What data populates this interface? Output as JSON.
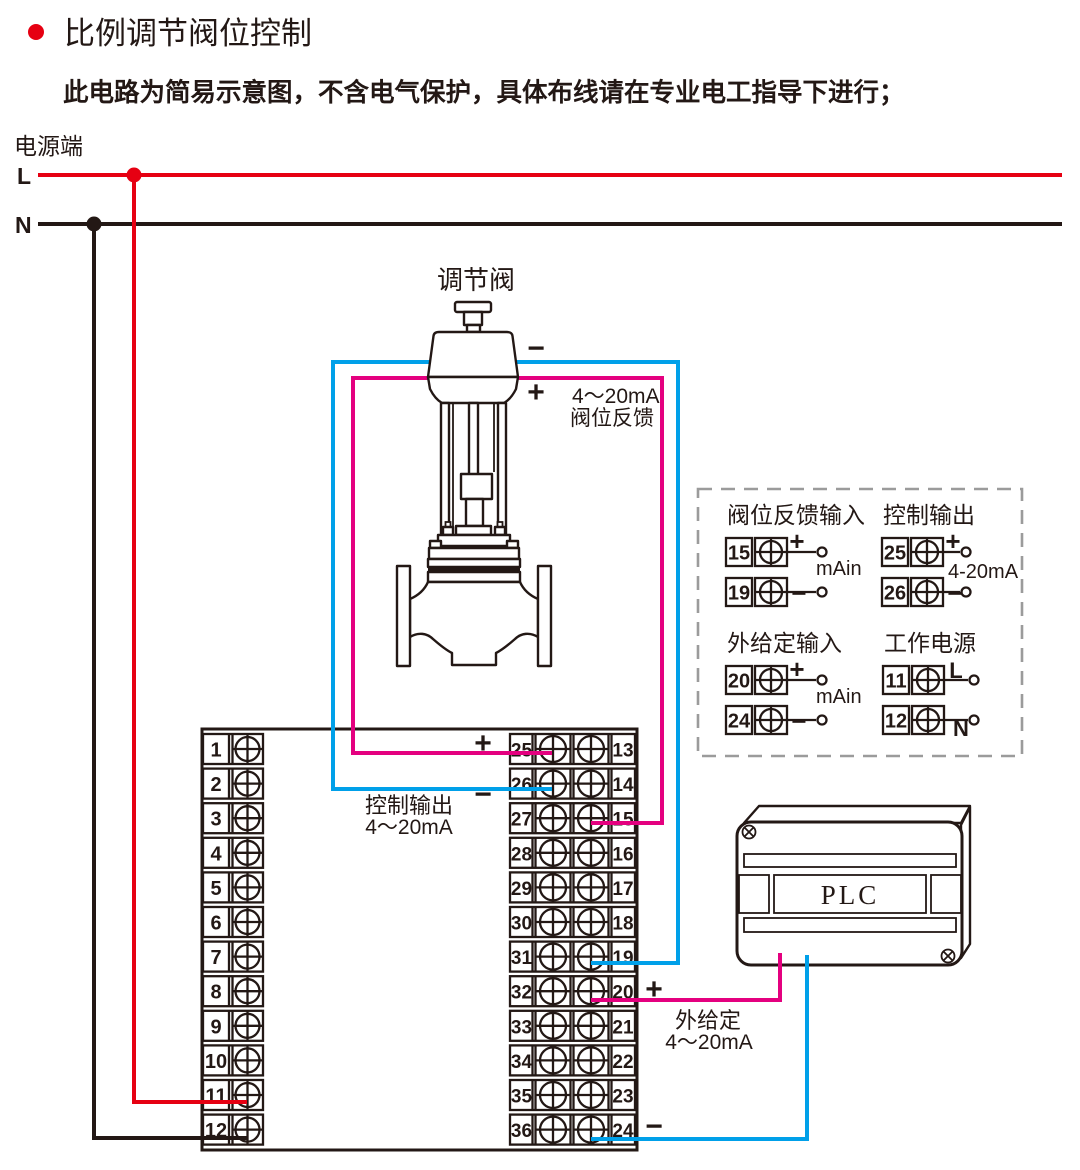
{
  "title": {
    "text": "比例调节阀位控制"
  },
  "subtitle": "此电路为简易示意图，不含电气保护，具体布线请在专业电工指导下进行；",
  "power": {
    "label": "电源端",
    "l": "L",
    "n": "N"
  },
  "valve": {
    "label": "调节阀",
    "minus": "−",
    "plus": "+",
    "feedback_note_line1": "4～20mA",
    "feedback_note_line2": "阀位反馈"
  },
  "control_output": {
    "label": "控制输出",
    "range": "4～20mA",
    "plus": "+",
    "minus": "−"
  },
  "setpoint": {
    "label": "外给定",
    "range": "4～20mA",
    "plus": "+",
    "minus": "−"
  },
  "plc": {
    "label": "PLC"
  },
  "instrument": {
    "terminals": {
      "left": [
        "1",
        "2",
        "3",
        "4",
        "5",
        "6",
        "7",
        "8",
        "9",
        "10",
        "11",
        "12"
      ],
      "mid_left": [
        "25",
        "26",
        "27",
        "28",
        "29",
        "30",
        "31",
        "32",
        "33",
        "34",
        "35",
        "36"
      ],
      "mid_right": [
        "13",
        "14",
        "15",
        "16",
        "17",
        "18",
        "19",
        "20",
        "21",
        "22",
        "23",
        "24"
      ]
    }
  },
  "legend": {
    "groups": [
      {
        "title": "阀位反馈输入",
        "note": "mAin",
        "rows": [
          {
            "no": "15",
            "sign": "+"
          },
          {
            "no": "19",
            "sign": "−"
          }
        ]
      },
      {
        "title": "控制输出",
        "note": "4-20mA",
        "rows": [
          {
            "no": "25",
            "sign": "+"
          },
          {
            "no": "26",
            "sign": "−"
          }
        ]
      },
      {
        "title": "外给定输入",
        "note": "mAin",
        "rows": [
          {
            "no": "20",
            "sign": "+"
          },
          {
            "no": "24",
            "sign": "−"
          }
        ]
      },
      {
        "title": "工作电源",
        "note": "",
        "rows": [
          {
            "no": "11",
            "sign": "L"
          },
          {
            "no": "12",
            "sign": "N"
          }
        ]
      }
    ]
  },
  "colors": {
    "line": "#231815",
    "red": "#e60012",
    "magenta": "#e4007f",
    "cyan": "#00a0e9",
    "dash_gray": "#9b9b9b"
  }
}
